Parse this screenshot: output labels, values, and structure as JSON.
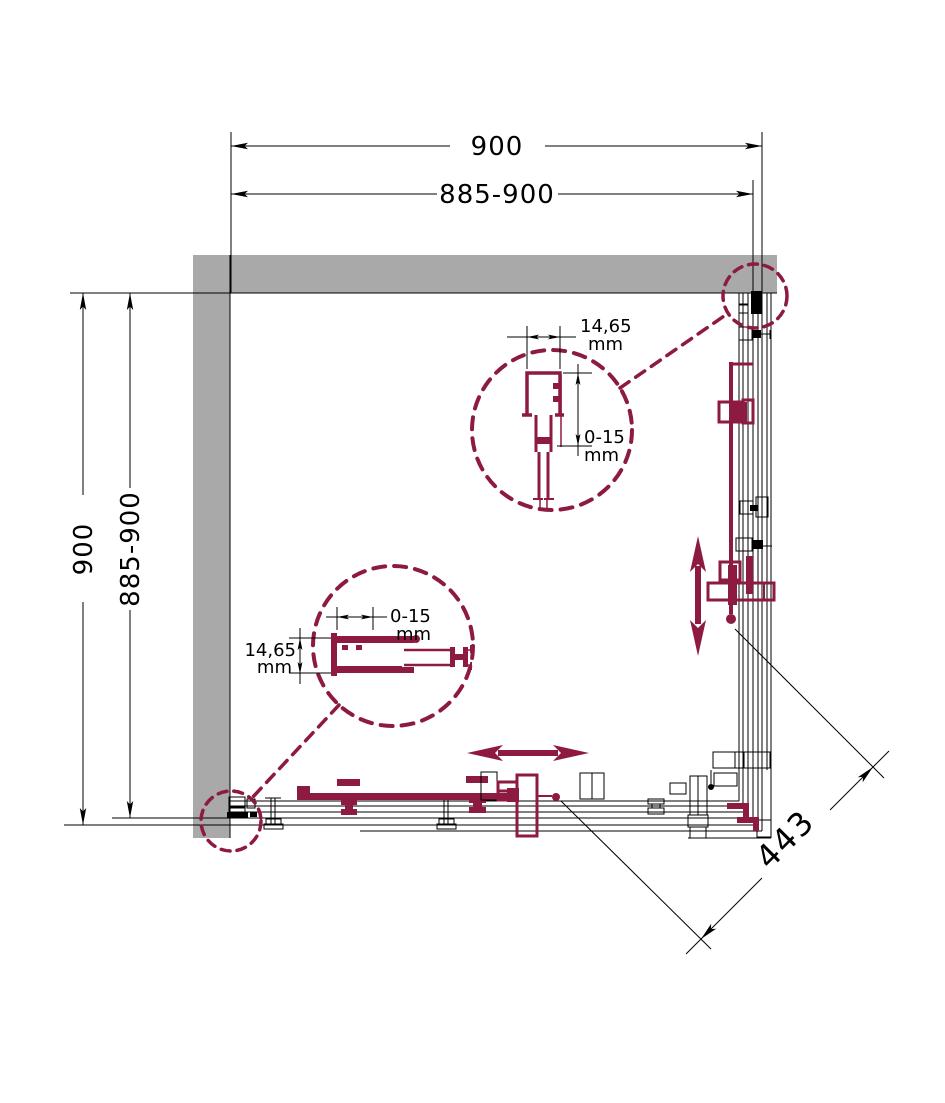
{
  "colors": {
    "profile_maroon": "#8d1a40",
    "wall_gray": "#a9a9a9",
    "line_black": "#000000",
    "background": "#ffffff"
  },
  "dimensions": {
    "top_width": "900",
    "top_adjustable_width": "885-900",
    "left_depth": "900",
    "left_adjustable_depth": "885-900",
    "diagonal_entry": "443"
  },
  "profile_details": {
    "top": {
      "profile_width": "14,65",
      "profile_width_unit": "mm",
      "adjustment_range": "0-15",
      "adjustment_range_unit": "mm"
    },
    "bottom_left": {
      "adjustment_range": "0-15",
      "adjustment_range_unit": "mm",
      "profile_width": "14,65",
      "profile_width_unit": "mm"
    }
  }
}
